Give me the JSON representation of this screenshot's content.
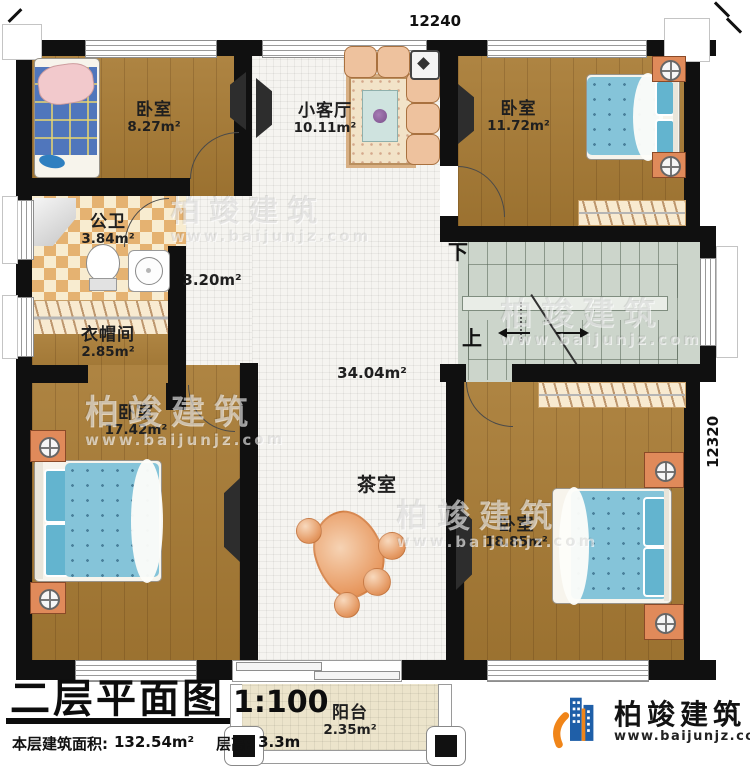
{
  "plan": {
    "dimensions": {
      "top": "12240",
      "right": "12320"
    },
    "rooms": {
      "bedroom_tl": {
        "name": "卧室",
        "area": "8.27m²"
      },
      "living": {
        "name": "小客厅",
        "area": "10.11m²"
      },
      "bedroom_tr": {
        "name": "卧室",
        "area": "11.72m²"
      },
      "bath": {
        "name": "公卫",
        "area": "3.84m²"
      },
      "hall_west": {
        "area": "3.20m²"
      },
      "closet": {
        "name": "衣帽间",
        "area": "2.85m²"
      },
      "hall": {
        "area": "34.04m²"
      },
      "tea_room": {
        "name": "茶室"
      },
      "bedroom_bl": {
        "name": "卧室",
        "area": "17.42m²"
      },
      "bedroom_br": {
        "name": "卧室",
        "area": "18.85m²"
      },
      "balcony": {
        "name": "阳台",
        "area": "2.35m²"
      }
    },
    "stairs": {
      "down": "下",
      "up": "上"
    }
  },
  "title_block": {
    "title": "二层平面图",
    "scale": "1:100",
    "area_label": "本层建筑面积:",
    "area_value": "132.54m²",
    "floor_height_label": "层高:",
    "floor_height_value": "3.3m"
  },
  "branding": {
    "company": "柏竣建筑",
    "website": "www.baijunjz.com"
  },
  "watermark": {
    "company": "柏竣建筑",
    "website": "www.baijunjz.com"
  },
  "colors": {
    "wall": "#101010",
    "wood_floor": "#a87b34",
    "tile_floor": "#f5f4f0",
    "checker_tile": "#e5b271",
    "stair_floor": "#ccd5cb",
    "balcony_floor": "#ece4cb",
    "bed_blue": "#85c4d9",
    "bed_plaid_blue": "#5076bc",
    "furniture_orange": "#e08a5a",
    "logo_blue": "#1f5fa8",
    "logo_orange": "#f08519"
  }
}
